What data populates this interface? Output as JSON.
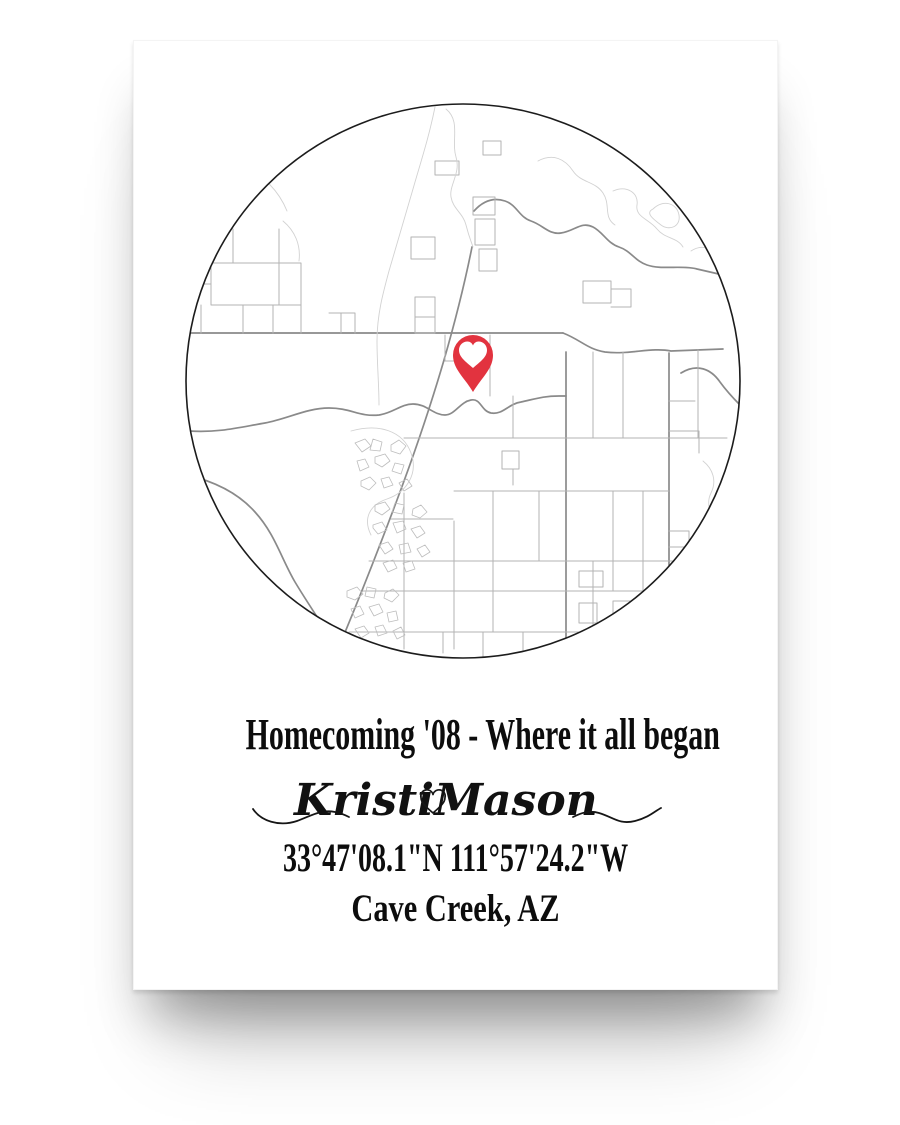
{
  "poster": {
    "title": "Homecoming '08 - Where it all began",
    "names": {
      "first": "Kristi",
      "second": "Mason"
    },
    "coordinates": "33°47'08.1\"N 111°57'24.2\"W",
    "location": "Cave Creek, AZ"
  },
  "colors": {
    "pin": "#e2333f",
    "pin_heart": "#ffffff",
    "circle_outline": "#1c1c1c",
    "major_road": "#8a8a8a",
    "road": "#b3b3b3",
    "light_road": "#d2d2d2",
    "cluster": "#bdbdbd",
    "text": "#0d0d0d"
  },
  "map": {
    "viewbox": "0 0 560 560",
    "circle": {
      "cx": 280,
      "cy": 280,
      "r": 277
    },
    "pin": {
      "x": 290,
      "y": 291,
      "pin_path": "M0,0 C-9,-15 -20,-23 -20,-37 A20,20 0 1 1 20,-37 C20,-23 9,-15 0,0 Z",
      "heart_path": "M0,-24 C-8,-31 -14,-35 -14,-42 C-14,-47 -10,-50.5 -5.5,-50.5 C-3,-50.5 -1,-49 0,-46.5 C1,-49 3,-50.5 5.5,-50.5 C10,-50.5 14,-47 14,-42 C14,-35 8,-31 0,-24 Z"
    },
    "paths": [
      {
        "c": "major",
        "d": "M291,110 C300,100 310,96 322,100 C334,104 336,116 348,120 C360,124 366,134 378,132 C392,130 398,120 410,126 C420,131 424,142 436,146 C448,150 452,160 464,164 C478,169 500,164 514,168 L540,174"
      },
      {
        "c": "major",
        "d": "M498,272 C514,262 528,268 537,281 C545,292 552,299 558,305"
      },
      {
        "c": "major",
        "d": "M289,146 C281,186 272,221 261,259 C247,307 232,351 214,399 C196,447 178,493 158,541 L147,566"
      },
      {
        "c": "major",
        "d": "M4,232 L380,232"
      },
      {
        "c": "major",
        "d": "M380,232 C398,239 404,248 422,251 C446,254 468,246 488,250 L540,248"
      },
      {
        "c": "major",
        "d": "M6,330 C36,332 58,326 82,322 C104,318 124,307 146,307 C168,307 176,316 196,314 C210,312 218,303 230,303 C244,303 250,314 262,314 C272,314 277,301 288,299 C298,297 298,310 308,312 C320,314 325,303 338,301 C352,298 360,295 376,295 L383,295"
      },
      {
        "c": "major",
        "d": "M383,251 L383,546"
      },
      {
        "c": "major",
        "d": "M486,252 L486,464"
      },
      {
        "c": "major",
        "d": "M4,374 C34,381 56,393 72,411 C92,433 98,457 112,481 C124,501 136,519 152,543 L158,554"
      },
      {
        "c": "road",
        "d": "M221,392 L221,548"
      },
      {
        "c": "road",
        "d": "M271,420 L271,548"
      },
      {
        "c": "road",
        "d": "M307,234 L307,295"
      },
      {
        "c": "road",
        "d": "M262,234 L262,260 L306,260"
      },
      {
        "c": "road",
        "d": "M330,295 L330,337"
      },
      {
        "c": "road",
        "d": "M410,251 L410,337"
      },
      {
        "c": "road",
        "d": "M440,251 L440,337"
      },
      {
        "c": "road",
        "d": "M515,249 L515,337"
      },
      {
        "c": "road",
        "d": "M221,337 L383,337"
      },
      {
        "c": "road",
        "d": "M383,337 L544,337"
      },
      {
        "c": "road",
        "d": "M271,390 L486,390"
      },
      {
        "c": "road",
        "d": "M208,418 L270,418"
      },
      {
        "c": "road",
        "d": "M186,460 L544,460"
      },
      {
        "c": "road",
        "d": "M180,490 L486,490"
      },
      {
        "c": "road",
        "d": "M166,531 L460,531"
      },
      {
        "c": "road",
        "d": "M310,390 L310,531"
      },
      {
        "c": "road",
        "d": "M356,390 L356,460"
      },
      {
        "c": "road",
        "d": "M430,390 L430,490"
      },
      {
        "c": "road",
        "d": "M460,390 L460,531"
      },
      {
        "c": "road",
        "d": "M410,460 L410,531"
      },
      {
        "c": "road",
        "d": "M300,531 L300,556 M260,531 L260,552 M340,531 L340,550"
      },
      {
        "c": "road",
        "d": "M28,162 H118 V204 H28 Z M50,128 V162 M96,128 V204 M12,183 H28"
      },
      {
        "c": "road",
        "d": "M18,204 V232 M60,204 V232 M90,204 V232 M118,204 V232"
      },
      {
        "c": "road",
        "d": "M252,60 H276 V74 H252 Z M300,40 H318 V54 H300 Z M228,136 H252 V158 H228 Z"
      },
      {
        "c": "road",
        "d": "M290,96 h22 v18 h-22 Z M292,118 h20 v26 h-20 Z M296,148 h18 v22 h-18 Z"
      },
      {
        "c": "road",
        "d": "M232,196 h20 v36 h-20 Z M232,216 h20"
      },
      {
        "c": "road",
        "d": "M146,212 h26 v20 M158,212 v20"
      },
      {
        "c": "road",
        "d": "M486,300 H512 M486,330 H516 V352 M486,430 H506 V446 H486"
      },
      {
        "c": "road",
        "d": "M396,470 H420 V486 H396 Z M430,500 H456 V514 H430 Z M396,502 H414 V522 H396 Z"
      },
      {
        "c": "road",
        "d": "M400,180 H428 V202 H400 Z M428,188 H448 V206 H428"
      },
      {
        "c": "road",
        "d": "M319,350 H336 V368 H319 Z M330,368 V384"
      },
      {
        "c": "light",
        "d": "M263,8 C278,20 268,40 273,56 C278,72 266,84 268,96 C270,108 280,112 283,124 C286,136 288,140 290,146"
      },
      {
        "c": "light",
        "d": "M252,6 C246,36 238,60 230,88 C222,116 214,142 206,170 C200,192 194,214 194,240 C194,262 196,284 196,304"
      },
      {
        "c": "light",
        "d": "M355,60 C370,52 382,58 390,70 C398,82 412,80 420,92 C428,104 420,116 432,124"
      },
      {
        "c": "light",
        "d": "M430,90 C444,84 456,92 454,104 C452,116 466,118 474,128 C482,138 494,136 500,146"
      },
      {
        "c": "light",
        "d": "M470,108 C480,98 494,102 496,114 C498,126 486,130 478,124 C470,118 462,112 470,108 Z"
      },
      {
        "c": "light",
        "d": "M508,150 C520,142 532,148 536,160"
      },
      {
        "c": "light",
        "d": "M520,360 C530,368 534,380 528,392 C522,404 530,412 526,422"
      },
      {
        "c": "light",
        "d": "M168,330 C196,322 220,330 228,352 C236,374 222,392 204,398 C186,404 180,418 188,434"
      },
      {
        "c": "light",
        "d": "M100,120 C112,130 118,144 116,160"
      },
      {
        "c": "light",
        "d": "M60,64 C80,74 96,90 104,110"
      },
      {
        "c": "cluster",
        "t": "translate(168,336)",
        "d": "M4,6 l10,-4 6,7 -9,6 z M22,2 l9,3 -2,9 -10,-1 z M40,8 l8,-5 7,6 -6,8 -9,-3 z M6,24 l8,-2 4,8 -9,4 z M24,20 l10,-3 5,7 -8,6 -7,-4 z M44,26 l9,2 -3,9 -9,-3 z M10,44 l9,-4 6,6 -7,7 -8,-4 z M30,42 l8,-2 4,8 -9,3 z M48,46 l8,-4 5,7 -8,5 z"
      },
      {
        "c": "cluster",
        "t": "translate(186,400)",
        "d": "M6,4 l10,-3 5,7 -8,6 -7,-4 z M26,2 l9,2 -2,9 -10,-2 z M44,8 l8,-4 6,7 -7,6 -8,-3 z M4,24 l9,-3 5,8 -9,4 -5,-6 z M24,22 l10,-2 3,8 -9,4 z M42,28 l9,-3 5,7 -8,5 z M10,44 l9,-3 5,7 -8,5 z M30,44 l9,-2 3,9 -10,2 z M48,48 l8,-4 5,7 -8,5 z M14,62 l10,-3 4,8 -9,4 z M34,62 l9,-2 3,8 -9,3 z"
      },
      {
        "c": "cluster",
        "t": "translate(160,482)",
        "d": "M4,8 l10,-4 6,7 -8,6 -8,-3 z M24,4 l9,2 -2,9 -9,-2 z M42,10 l8,-4 6,6 -7,7 -8,-4 z M8,26 l9,-3 4,8 -9,4 z M26,24 l10,-3 4,8 -9,4 z M44,30 l9,-2 2,9 -9,2 z M12,46 l9,-3 5,7 -8,5 z M32,44 l8,-2 4,8 -9,3 z M50,48 l8,-4 4,8 -8,4 z M20,62 l9,-3 4,8 -9,3 z"
      }
    ]
  }
}
